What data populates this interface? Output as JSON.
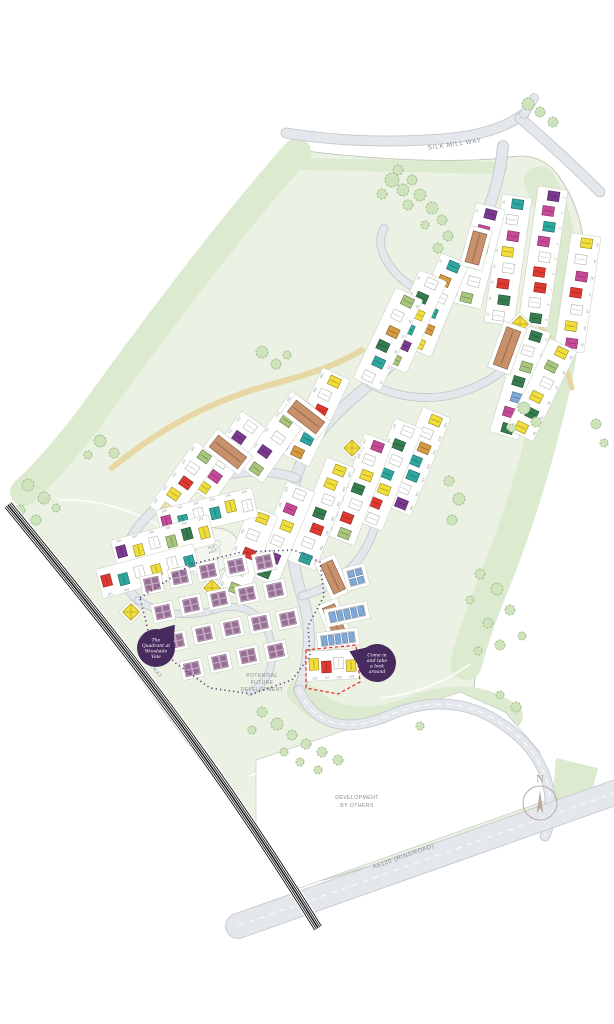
{
  "title": "The Quadrant at Woodside Vale site plan",
  "labels": {
    "silk_mill_way": "SILK MILL WAY",
    "railway": "RAILWAY",
    "ringroad": "A6120 (RINGROAD)",
    "potential_future": [
      "POTENTIAL",
      "FUTURE",
      "DEVELOPMENT"
    ],
    "dev_by_others": [
      "DEVELOPMENT",
      "BY OTHERS"
    ],
    "play_area": [
      "PLAY",
      "AREA"
    ],
    "compass_n": "N"
  },
  "badges": [
    {
      "name": "site-name-badge",
      "lines": [
        "The",
        "Quadrant at",
        "Woodside",
        "Vale"
      ]
    },
    {
      "name": "welcome-badge",
      "lines": [
        "Come in",
        "and take",
        "a look",
        "around"
      ]
    }
  ],
  "palette": {
    "badge": "#472a5e",
    "site_green": "#ebf2e3",
    "band_green": "#dcebd0",
    "lawn_green": "#d9e8cb",
    "tree_fill": "#cfe4bc",
    "tree_stroke": "#9bb88b",
    "road_fill": "#e4e8ec",
    "road_edge": "#c3c9cd",
    "path_tan": "#e6d7a5",
    "parcel_stroke": "#c5cabf",
    "railway_black": "#161616",
    "boundary_purple": "#5d3b74",
    "boundary_red": "#e0392f",
    "label_gray": "#858d92",
    "number_gray": "#8b9196",
    "compass": "#b3a597",
    "mauve": "#c7a6c4",
    "mauve_dark": "#966f94",
    "house_colors": {
      "pu": "#7b3990",
      "mg": "#c74a98",
      "te": "#2fa7a0",
      "rd": "#df3a31",
      "dg": "#357d4f",
      "ol": "#a8c77c",
      "ye": "#f2de3b",
      "py": "#eee3a2",
      "or": "#d69a40",
      "bl": "#7fa9d8",
      "wh": "#ffffff",
      "br": "#c8906b"
    }
  },
  "map": {
    "site": {
      "d": "M 298 150 C 360 158 440 164 505 158 C 530 152 548 160 560 178 C 585 215 590 255 578 305 C 568 350 560 400 548 455 C 536 510 515 570 492 625 C 480 654 472 680 474 700 C 500 712 528 736 542 764 C 550 782 552 800 548 814 L 350 872 C 320 882 300 888 286 876 L 258 838 L 120 652 L 30 530 C 20 516 18 504 26 492 C 60 440 120 360 180 288 C 220 240 260 190 298 150 Z"
    },
    "bands": [
      {
        "d": "M 297 152 C 240 215 160 320 88 420 C 55 462 38 480 24 492",
        "w": 28
      },
      {
        "d": "M 540 182 C 568 240 572 300 556 380 C 540 450 520 520 492 588 C 478 622 470 648 466 664",
        "w": 32
      },
      {
        "d": "M 302 164 L 502 168",
        "w": 12
      },
      {
        "d": "M 300 692 C 330 724 370 726 410 710 C 450 694 482 696 510 716",
        "w": 26
      }
    ],
    "wedge": {
      "pts": [
        [
          556,
          758
        ],
        [
          598,
          768
        ],
        [
          588,
          808
        ],
        [
          552,
          800
        ]
      ]
    },
    "dev_parcel": {
      "pts": [
        [
          256,
          760
        ],
        [
          460,
          692
        ],
        [
          505,
          712
        ],
        [
          540,
          752
        ],
        [
          548,
          800
        ],
        [
          350,
          870
        ],
        [
          300,
          888
        ],
        [
          256,
          838
        ]
      ]
    },
    "roads": [
      {
        "name": "silk-mill-way",
        "d": "M 286 133 C 340 142 400 143 452 138 C 480 135 505 128 524 114",
        "w": 9
      },
      {
        "name": "silk-mill-way-east",
        "d": "M 520 118 C 542 137 570 162 600 192",
        "w": 9
      },
      {
        "name": "junction-stub",
        "d": "M 524 114 L 534 98",
        "w": 8
      },
      {
        "name": "spine-road",
        "d": "M 503 146 C 500 176 494 196 484 220 C 470 254 462 272 446 300 C 428 332 402 356 372 382 C 334 414 306 440 296 478 C 287 515 289 556 302 596 C 312 626 311 658 299 690",
        "w": 10
      },
      {
        "name": "exit-road",
        "d": "M 299 690 C 314 724 344 734 388 716 C 428 698 468 700 502 724 C 532 744 548 770 550 800 C 551 814 549 826 545 836",
        "w": 9,
        "marking": true
      },
      {
        "name": "ringroad",
        "d": "M 238 926 L 614 793",
        "w": 24,
        "marking": true
      },
      {
        "name": "loop-upper",
        "d": "M 450 298 C 426 296 404 286 390 266 C 380 252 378 240 384 228",
        "w": 7
      },
      {
        "name": "loop-east",
        "d": "M 370 384 C 398 398 432 402 462 392 C 492 382 512 366 522 346",
        "w": 7
      },
      {
        "name": "loop-west",
        "d": "M 296 478 C 266 468 232 470 198 484 C 164 498 140 518 128 544 C 118 566 122 586 138 600",
        "w": 8
      },
      {
        "name": "loop-south",
        "d": "M 302 596 C 330 588 352 572 366 548 C 378 526 382 500 378 474",
        "w": 7
      },
      {
        "name": "cul-de-sac-left",
        "d": "M 138 600 C 158 614 186 618 214 610",
        "w": 6
      },
      {
        "name": "quadrant-lane",
        "d": "M 214 610 C 246 600 268 616 272 648 C 274 668 266 684 250 692",
        "w": 6
      }
    ],
    "footpaths": [
      {
        "d": "M 112 468 C 160 428 214 400 266 386 C 306 375 336 366 362 350",
        "w": 6
      },
      {
        "d": "M 540 326 C 556 344 566 364 572 388",
        "w": 5
      }
    ],
    "trails": [
      {
        "d": "M 60 500 C 110 498 160 520 205 556"
      },
      {
        "d": "M 250 776 C 300 756 352 746 404 742"
      },
      {
        "d": "M 470 664 C 446 682 414 694 382 698"
      }
    ],
    "railway": {
      "d": "M 8 505 C 110 630 205 745 318 928"
    },
    "play": {
      "cx": 209,
      "cy": 551,
      "rx": 30,
      "ry": 22,
      "rot": -20
    },
    "strips": [
      {
        "x1": 552,
        "y1": 196,
        "x2": 534,
        "y2": 318,
        "start": 1,
        "side": -1,
        "colors": [
          "pu",
          "mg",
          "te",
          "mg",
          "wh",
          "rd",
          "rd",
          "wh",
          "dg"
        ]
      },
      {
        "x1": 516,
        "y1": 204,
        "x2": 500,
        "y2": 316,
        "start": 10,
        "side": 1,
        "colors": [
          "te",
          "wh",
          "mg",
          "ye",
          "wh",
          "rd",
          "dg",
          "wh"
        ]
      },
      {
        "x1": 489,
        "y1": 214,
        "x2": 468,
        "y2": 298,
        "start": 31,
        "side": 1,
        "colors": [
          "pu",
          "mg",
          "or",
          "py",
          "wh",
          "ol"
        ]
      },
      {
        "x1": 534,
        "y1": 336,
        "x2": 506,
        "y2": 428,
        "start": 17,
        "side": -1,
        "colors": [
          "dg",
          "wh",
          "ol",
          "dg",
          "bl",
          "mg",
          "dg"
        ]
      },
      {
        "x1": 585,
        "y1": 243,
        "x2": 570,
        "y2": 343,
        "start": 24,
        "side": -1,
        "colors": [
          "ye",
          "wh",
          "mg",
          "rd",
          "wh",
          "ye",
          "mg"
        ]
      },
      {
        "x1": 452,
        "y1": 266,
        "x2": 420,
        "y2": 344,
        "start": 37,
        "side": 1,
        "colors": [
          "te",
          "or",
          "wh",
          "te",
          "or",
          "ye"
        ]
      },
      {
        "x1": 430,
        "y1": 283,
        "x2": 396,
        "y2": 360,
        "start": 43,
        "side": 1,
        "colors": [
          "wh",
          "dg",
          "ye",
          "te",
          "pu",
          "ol"
        ]
      },
      {
        "x1": 406,
        "y1": 301,
        "x2": 370,
        "y2": 377,
        "start": 49,
        "side": -1,
        "colors": [
          "ol",
          "wh",
          "or",
          "dg",
          "te",
          "wh"
        ]
      },
      {
        "x1": 560,
        "y1": 352,
        "x2": 523,
        "y2": 428,
        "start": 55,
        "side": -1,
        "colors": [
          "ye",
          "ol",
          "wh",
          "ye",
          "dg",
          "ye"
        ]
      },
      {
        "x1": 333,
        "y1": 381,
        "x2": 299,
        "y2": 453,
        "start": 203,
        "side": 1,
        "colors": [
          "ye",
          "wh",
          "rd",
          "mg",
          "te",
          "or"
        ]
      },
      {
        "x1": 299,
        "y1": 406,
        "x2": 255,
        "y2": 468,
        "start": 209,
        "side": 1,
        "colors": [
          "pu",
          "ol",
          "wh",
          "pu",
          "ol"
        ]
      },
      {
        "x1": 249,
        "y1": 426,
        "x2": 205,
        "y2": 488,
        "start": 214,
        "side": 1,
        "colors": [
          "wh",
          "pu",
          "dg",
          "wh",
          "mg",
          "ye"
        ]
      },
      {
        "x1": 203,
        "y1": 456,
        "x2": 166,
        "y2": 508,
        "start": 220,
        "side": 1,
        "colors": [
          "ol",
          "wh",
          "rd",
          "ye",
          "py"
        ]
      },
      {
        "x1": 434,
        "y1": 420,
        "x2": 400,
        "y2": 503,
        "start": 140,
        "side": -1,
        "colors": [
          "ye",
          "wh",
          "or",
          "te",
          "te",
          "wh",
          "pu"
        ]
      },
      {
        "x1": 406,
        "y1": 431,
        "x2": 371,
        "y2": 518,
        "start": 147,
        "side": 1,
        "colors": [
          "wh",
          "dg",
          "wh",
          "te",
          "ye",
          "rd",
          "wh"
        ]
      },
      {
        "x1": 376,
        "y1": 446,
        "x2": 343,
        "y2": 533,
        "start": 154,
        "side": 1,
        "colors": [
          "mg",
          "wh",
          "ye",
          "dg",
          "wh",
          "rd",
          "ol"
        ]
      },
      {
        "x1": 338,
        "y1": 470,
        "x2": 304,
        "y2": 558,
        "start": 193,
        "side": -1,
        "colors": [
          "ye",
          "ye",
          "wh",
          "dg",
          "rd",
          "wh",
          "te"
        ]
      },
      {
        "x1": 298,
        "y1": 494,
        "x2": 266,
        "y2": 573,
        "start": 186,
        "side": 1,
        "colors": [
          "wh",
          "mg",
          "ye",
          "wh",
          "pu",
          "dg"
        ]
      },
      {
        "x1": 261,
        "y1": 518,
        "x2": 234,
        "y2": 588,
        "start": 230,
        "side": 1,
        "colors": [
          "ye",
          "wh",
          "rd",
          "wh",
          "ol"
        ]
      },
      {
        "x1": 167,
        "y1": 523,
        "x2": 247,
        "y2": 504,
        "start": 240,
        "side": -1,
        "colors": [
          "mg",
          "te",
          "wh",
          "te",
          "ye",
          "wh"
        ]
      },
      {
        "x1": 122,
        "y1": 553,
        "x2": 204,
        "y2": 531,
        "start": 246,
        "side": -1,
        "colors": [
          "pu",
          "ye",
          "wh",
          "ol",
          "dg",
          "ye"
        ]
      },
      {
        "x1": 107,
        "y1": 582,
        "x2": 189,
        "y2": 560,
        "start": 251,
        "side": 1,
        "colors": [
          "rd",
          "te",
          "wh",
          "ye",
          "wh",
          "te"
        ]
      },
      {
        "x1": 314,
        "y1": 666,
        "x2": 351,
        "y2": 664,
        "start": 236,
        "side": 1,
        "colors": [
          "ye",
          "rd",
          "wh",
          "ye"
        ]
      }
    ],
    "diamonds": [
      {
        "x": 352,
        "y": 448
      },
      {
        "x": 212,
        "y": 588
      },
      {
        "x": 131,
        "y": 612
      },
      {
        "x": 520,
        "y": 324
      }
    ],
    "flats": [
      {
        "x": 347,
        "y": 614,
        "rot": -12,
        "len": 36,
        "rows": 1,
        "cells": 5
      },
      {
        "x": 338,
        "y": 639,
        "rot": -8,
        "len": 34,
        "rows": 1,
        "cells": 5
      },
      {
        "x": 356,
        "y": 577,
        "rot": -15,
        "len": 15,
        "rows": 2,
        "cells": 2
      }
    ],
    "apartments": [
      {
        "x": 476,
        "y": 248,
        "rot": 15,
        "w": 14,
        "h": 32
      },
      {
        "x": 507,
        "y": 348,
        "rot": 20,
        "w": 15,
        "h": 40
      },
      {
        "x": 306,
        "y": 417,
        "rot": -52,
        "w": 15,
        "h": 36
      },
      {
        "x": 228,
        "y": 452,
        "rot": -52,
        "w": 15,
        "h": 36
      },
      {
        "x": 333,
        "y": 577,
        "rot": -25,
        "w": 13,
        "h": 32
      },
      {
        "x": 334,
        "y": 620,
        "rot": -22,
        "w": 13,
        "h": 30
      }
    ],
    "mauve_area": {
      "rot": -12,
      "blocks": [
        [
          152,
          584
        ],
        [
          180,
          577
        ],
        [
          208,
          571
        ],
        [
          236,
          566
        ],
        [
          264,
          562
        ],
        [
          163,
          612
        ],
        [
          191,
          605
        ],
        [
          219,
          599
        ],
        [
          247,
          594
        ],
        [
          275,
          590
        ],
        [
          176,
          641
        ],
        [
          204,
          634
        ],
        [
          232,
          628
        ],
        [
          260,
          623
        ],
        [
          288,
          619
        ],
        [
          192,
          669
        ],
        [
          220,
          662
        ],
        [
          248,
          656
        ],
        [
          276,
          651
        ]
      ]
    },
    "boundaries": [
      {
        "name": "quadrant-boundary",
        "color": "boundary_purple",
        "w": 1.6,
        "dash": "1.2 3.2",
        "close": true,
        "pts": [
          [
            140,
            598
          ],
          [
            192,
            564
          ],
          [
            242,
            552
          ],
          [
            294,
            550
          ],
          [
            320,
            562
          ],
          [
            324,
            596
          ],
          [
            308,
            626
          ],
          [
            310,
            656
          ],
          [
            292,
            680
          ],
          [
            252,
            694
          ],
          [
            210,
            688
          ],
          [
            174,
            662
          ],
          [
            148,
            630
          ]
        ]
      },
      {
        "name": "sales-area-boundary",
        "color": "boundary_red",
        "w": 1.3,
        "dash": "3.4 2.4",
        "close": true,
        "pts": [
          [
            306,
            650
          ],
          [
            356,
            645
          ],
          [
            360,
            682
          ],
          [
            338,
            694
          ],
          [
            306,
            688
          ]
        ]
      }
    ],
    "trees": [
      [
        392,
        180,
        7
      ],
      [
        403,
        190,
        6
      ],
      [
        382,
        194,
        5
      ],
      [
        412,
        180,
        5
      ],
      [
        398,
        170,
        5
      ],
      [
        420,
        195,
        6
      ],
      [
        408,
        205,
        5
      ],
      [
        432,
        208,
        6
      ],
      [
        442,
        220,
        5
      ],
      [
        425,
        225,
        4
      ],
      [
        448,
        236,
        5
      ],
      [
        438,
        248,
        5
      ],
      [
        528,
        104,
        6
      ],
      [
        540,
        112,
        5
      ],
      [
        553,
        122,
        5
      ],
      [
        262,
        352,
        6
      ],
      [
        276,
        364,
        5
      ],
      [
        287,
        355,
        4
      ],
      [
        100,
        441,
        6
      ],
      [
        114,
        453,
        5
      ],
      [
        88,
        455,
        4
      ],
      [
        28,
        485,
        6
      ],
      [
        44,
        498,
        6
      ],
      [
        20,
        510,
        5
      ],
      [
        36,
        520,
        5
      ],
      [
        56,
        508,
        4
      ],
      [
        524,
        408,
        6
      ],
      [
        536,
        422,
        5
      ],
      [
        512,
        428,
        4
      ],
      [
        596,
        424,
        5
      ],
      [
        604,
        443,
        4
      ],
      [
        449,
        481,
        5
      ],
      [
        459,
        499,
        6
      ],
      [
        452,
        520,
        5
      ],
      [
        480,
        574,
        5
      ],
      [
        497,
        589,
        6
      ],
      [
        470,
        600,
        4
      ],
      [
        510,
        610,
        5
      ],
      [
        488,
        623,
        5
      ],
      [
        522,
        636,
        4
      ],
      [
        500,
        645,
        5
      ],
      [
        478,
        651,
        4
      ],
      [
        262,
        712,
        5
      ],
      [
        277,
        724,
        6
      ],
      [
        292,
        735,
        5
      ],
      [
        306,
        744,
        5
      ],
      [
        322,
        752,
        5
      ],
      [
        338,
        760,
        5
      ],
      [
        284,
        752,
        4
      ],
      [
        300,
        762,
        4
      ],
      [
        252,
        730,
        4
      ],
      [
        318,
        770,
        4
      ],
      [
        420,
        726,
        4
      ],
      [
        500,
        695,
        4
      ],
      [
        516,
        707,
        5
      ]
    ],
    "compass": {
      "cx": 540,
      "cy": 803,
      "r": 17
    }
  }
}
